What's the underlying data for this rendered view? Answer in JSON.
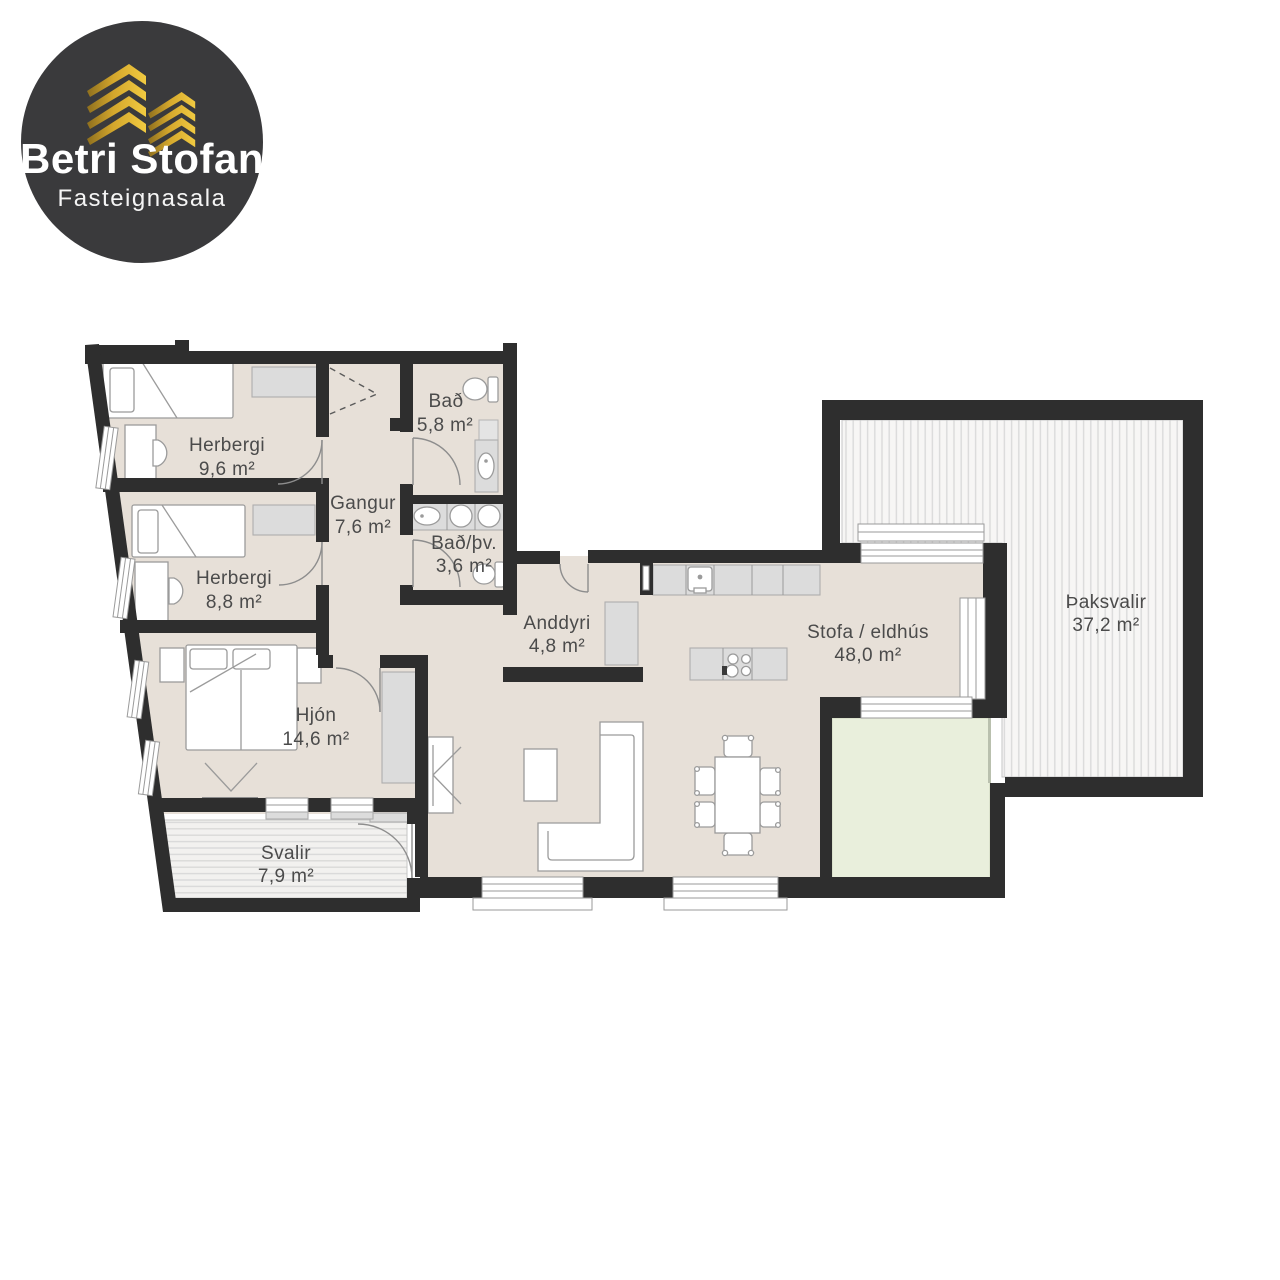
{
  "logo": {
    "title": "Betri Stofan",
    "subtitle": "Fasteignasala"
  },
  "rooms": {
    "herbergi1": {
      "name": "Herbergi",
      "area": "9,6 m²"
    },
    "herbergi2": {
      "name": "Herbergi",
      "area": "8,8 m²"
    },
    "gangur": {
      "name": "Gangur",
      "area": "7,6 m²"
    },
    "bad": {
      "name": "Bað",
      "area": "5,8 m²"
    },
    "bad_thv": {
      "name": "Bað/þv.",
      "area": "3,6 m²"
    },
    "anddyri": {
      "name": "Anddyri",
      "area": "4,8 m²"
    },
    "hjon": {
      "name": "Hjón",
      "area": "14,6 m²"
    },
    "stofa": {
      "name": "Stofa / eldhús",
      "area": "48,0 m²"
    },
    "svalir": {
      "name": "Svalir",
      "area": "7,9 m²"
    },
    "thaksvalir": {
      "name": "Þaksvalir",
      "area": "37,2 m²"
    }
  },
  "colors": {
    "wall": "#2e2e2e",
    "floor": "#e7e0d8",
    "green_area": "#e9efdc",
    "deck_stripe": "#d9d9d9",
    "logo_background": "#3a3a3c",
    "gold_accent": "#d4a72c",
    "label_text": "#4b4b4b"
  }
}
